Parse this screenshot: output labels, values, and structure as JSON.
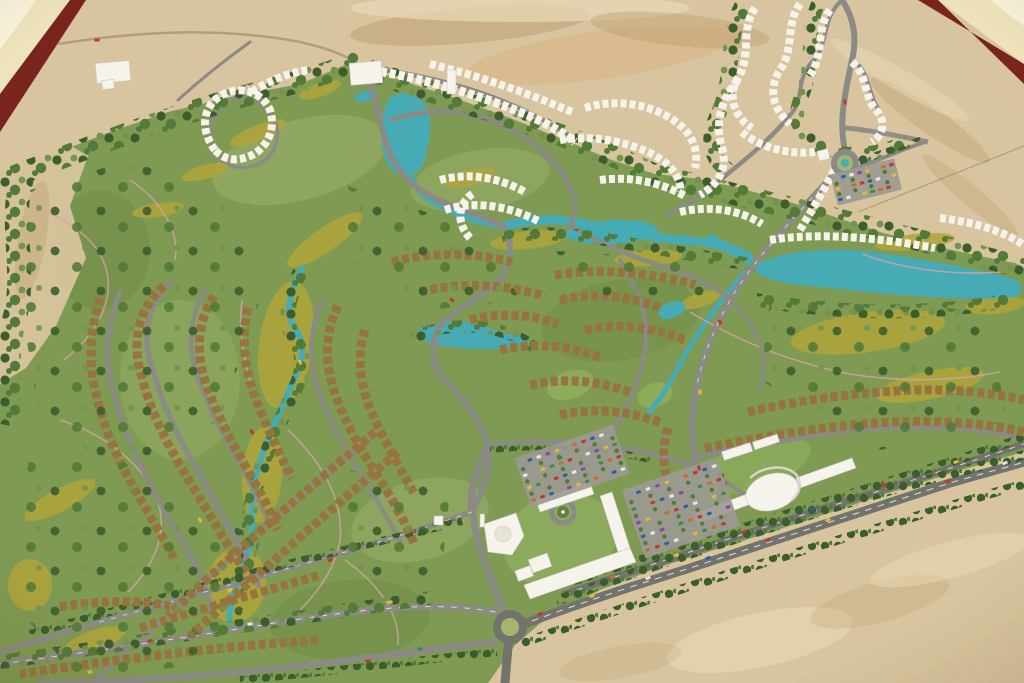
{
  "scene": {
    "description": "Photograph of a physical architectural scale model of a desert golf-resort master plan: sand terrain, green golf fairways, teal lagoons and streams, winding grey streets lined with brown-roofed villa rows, white condo clusters, a mosque and school complex, parking lots with tiny cars, roundabouts and a tree-lined boulevard, with the cream table and maroon model frame visible at the top corners.",
    "regions": [
      "table-corner",
      "model-frame",
      "desert-sand",
      "golf-green",
      "fairway",
      "lagoon",
      "stream",
      "villa-rows",
      "white-condo-rows",
      "mosque",
      "school-complex",
      "clubhouse",
      "parking-lot",
      "roundabout",
      "boulevard",
      "highway"
    ]
  },
  "palette": {
    "table_cream": "#efe3bb",
    "table_bright": "#faf4dc",
    "frame_maroon": "#79241e",
    "sand": "#d8c49e",
    "sand_light": "#e9dab8",
    "sand_dark": "#bb9a6c",
    "sand_orange": "#d9b584",
    "green": "#7f9a52",
    "green_light": "#a3b670",
    "green_dark": "#62803e",
    "lawn": "#8fae5e",
    "fairway": "#b2a53c",
    "tree_dark": "#3c5e2e",
    "tree_mid": "#547a39",
    "tree_light": "#74934f",
    "water": "#47abb5",
    "water_light": "#7cc7cd",
    "road": "#8b8a85",
    "road_dark": "#73736e",
    "road_line": "#eceae2",
    "path_pink": "#d4a3ab",
    "roof_brown": "#97743f",
    "roof_dark": "#6b5638",
    "building_white": "#f5f3ec",
    "building_shadow": "#c9c7bf",
    "parking_asphalt": "#9b9a93",
    "car_colors": [
      "#c0392b",
      "#e3b73e",
      "#2e5fa3",
      "#3c8a45",
      "#e5e5e1",
      "#c96a2e",
      "#8e44ad"
    ]
  },
  "parking_lots": [
    {
      "name": "west-lot",
      "cx": 572,
      "cy": 466,
      "w": 104,
      "h": 52,
      "rot": -19,
      "rows": 4,
      "cols": 11
    },
    {
      "name": "east-lot",
      "cx": 681,
      "cy": 508,
      "w": 100,
      "h": 72,
      "rot": -19,
      "rows": 5,
      "cols": 10
    },
    {
      "name": "northeast-lot",
      "cx": 866,
      "cy": 182,
      "w": 66,
      "h": 32,
      "rot": -14,
      "rows": 3,
      "cols": 8
    }
  ],
  "road_cars": [
    {
      "x": 540,
      "y": 614,
      "c": 0,
      "r": -19
    },
    {
      "x": 592,
      "y": 596,
      "c": 1,
      "r": -19
    },
    {
      "x": 648,
      "y": 578,
      "c": 4,
      "r": -19
    },
    {
      "x": 708,
      "y": 558,
      "c": 2,
      "r": -19
    },
    {
      "x": 768,
      "y": 540,
      "c": 0,
      "r": -19
    },
    {
      "x": 828,
      "y": 520,
      "c": 1,
      "r": -19
    },
    {
      "x": 888,
      "y": 500,
      "c": 3,
      "r": -19
    },
    {
      "x": 948,
      "y": 481,
      "c": 0,
      "r": -19
    },
    {
      "x": 1005,
      "y": 463,
      "c": 4,
      "r": -19
    },
    {
      "x": 612,
      "y": 577,
      "c": 5,
      "r": -19
    },
    {
      "x": 676,
      "y": 555,
      "c": 1,
      "r": -19
    },
    {
      "x": 744,
      "y": 532,
      "c": 0,
      "r": -19
    },
    {
      "x": 812,
      "y": 509,
      "c": 2,
      "r": -19
    },
    {
      "x": 884,
      "y": 485,
      "c": 0,
      "r": -19
    },
    {
      "x": 956,
      "y": 462,
      "c": 1,
      "r": -19
    },
    {
      "x": 390,
      "y": 602,
      "c": 1,
      "r": -8
    },
    {
      "x": 368,
      "y": 661,
      "c": 0,
      "r": -8
    },
    {
      "x": 420,
      "y": 649,
      "c": 3,
      "r": -8
    },
    {
      "x": 250,
      "y": 624,
      "c": 4,
      "r": -8
    },
    {
      "x": 150,
      "y": 641,
      "c": 0,
      "r": -8
    },
    {
      "x": 90,
      "y": 672,
      "c": 1,
      "r": -8
    },
    {
      "x": 330,
      "y": 560,
      "c": 0,
      "r": -18
    },
    {
      "x": 230,
      "y": 590,
      "c": 1,
      "r": -18
    },
    {
      "x": 720,
      "y": 322,
      "c": 0,
      "r": 60
    },
    {
      "x": 700,
      "y": 392,
      "c": 1,
      "r": 75
    },
    {
      "x": 699,
      "y": 468,
      "c": 0,
      "r": 85
    },
    {
      "x": 845,
      "y": 102,
      "c": 0,
      "r": 85
    },
    {
      "x": 452,
      "y": 300,
      "c": 0,
      "r": 40
    },
    {
      "x": 300,
      "y": 362,
      "c": 1,
      "r": 70
    },
    {
      "x": 252,
      "y": 432,
      "c": 0,
      "r": 65
    },
    {
      "x": 200,
      "y": 520,
      "c": 1,
      "r": 60
    },
    {
      "x": 560,
      "y": 458,
      "c": 3,
      "r": -19
    },
    {
      "x": 97,
      "y": 40,
      "c": 0,
      "r": 0
    }
  ]
}
